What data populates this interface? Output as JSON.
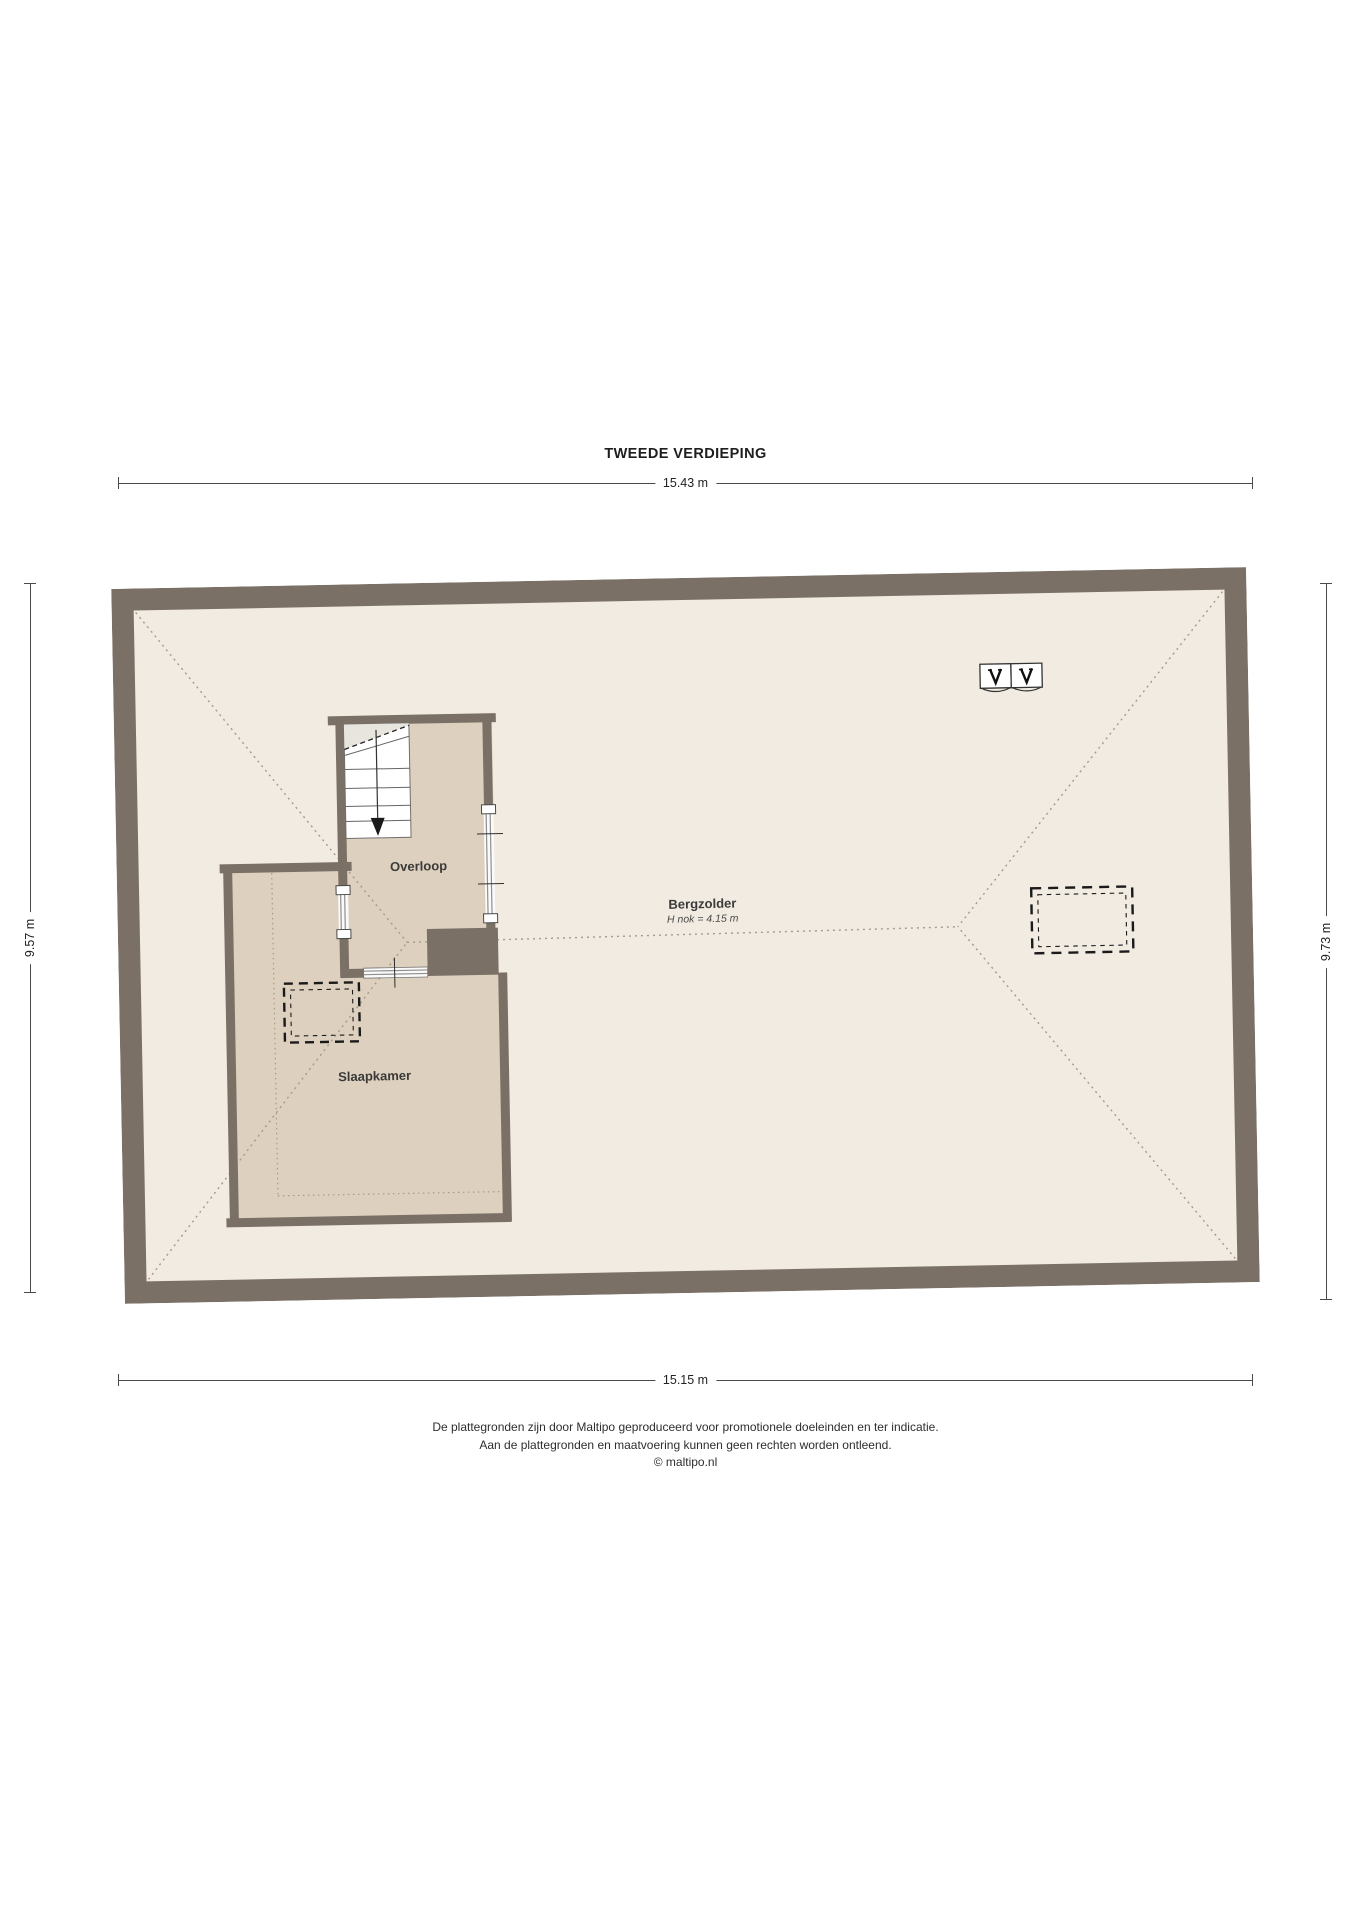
{
  "title": "TWEEDE VERDIEPING",
  "dimensions": {
    "top": "15.43 m",
    "bottom": "15.15 m",
    "left": "9.57 m",
    "right": "9.73 m"
  },
  "rooms": {
    "bergzolder": {
      "label": "Bergzolder",
      "height_note": "H nok = 4.15 m"
    },
    "overloop": {
      "label": "Overloop"
    },
    "slaapkamer": {
      "label": "Slaapkamer"
    }
  },
  "footer": {
    "line1": "De plattegronden zijn door Maltipo geproduceerd voor promotionele doeleinden en ter indicatie.",
    "line2": "Aan de plattegronden en maatvoering kunnen geen rechten worden ontleend.",
    "line3": "© maltipo.nl"
  },
  "icons": {
    "roof_window": "roof-window-icon",
    "stair_arrow": "stair-down-arrow-icon"
  },
  "colors": {
    "wall": "#7b7066",
    "attic_floor": "#f1ebe1",
    "room_floor": "#ddd0be",
    "roof_dotted_lines": "#a59a8b",
    "dashed_roof_window": "#1a1a1a"
  }
}
